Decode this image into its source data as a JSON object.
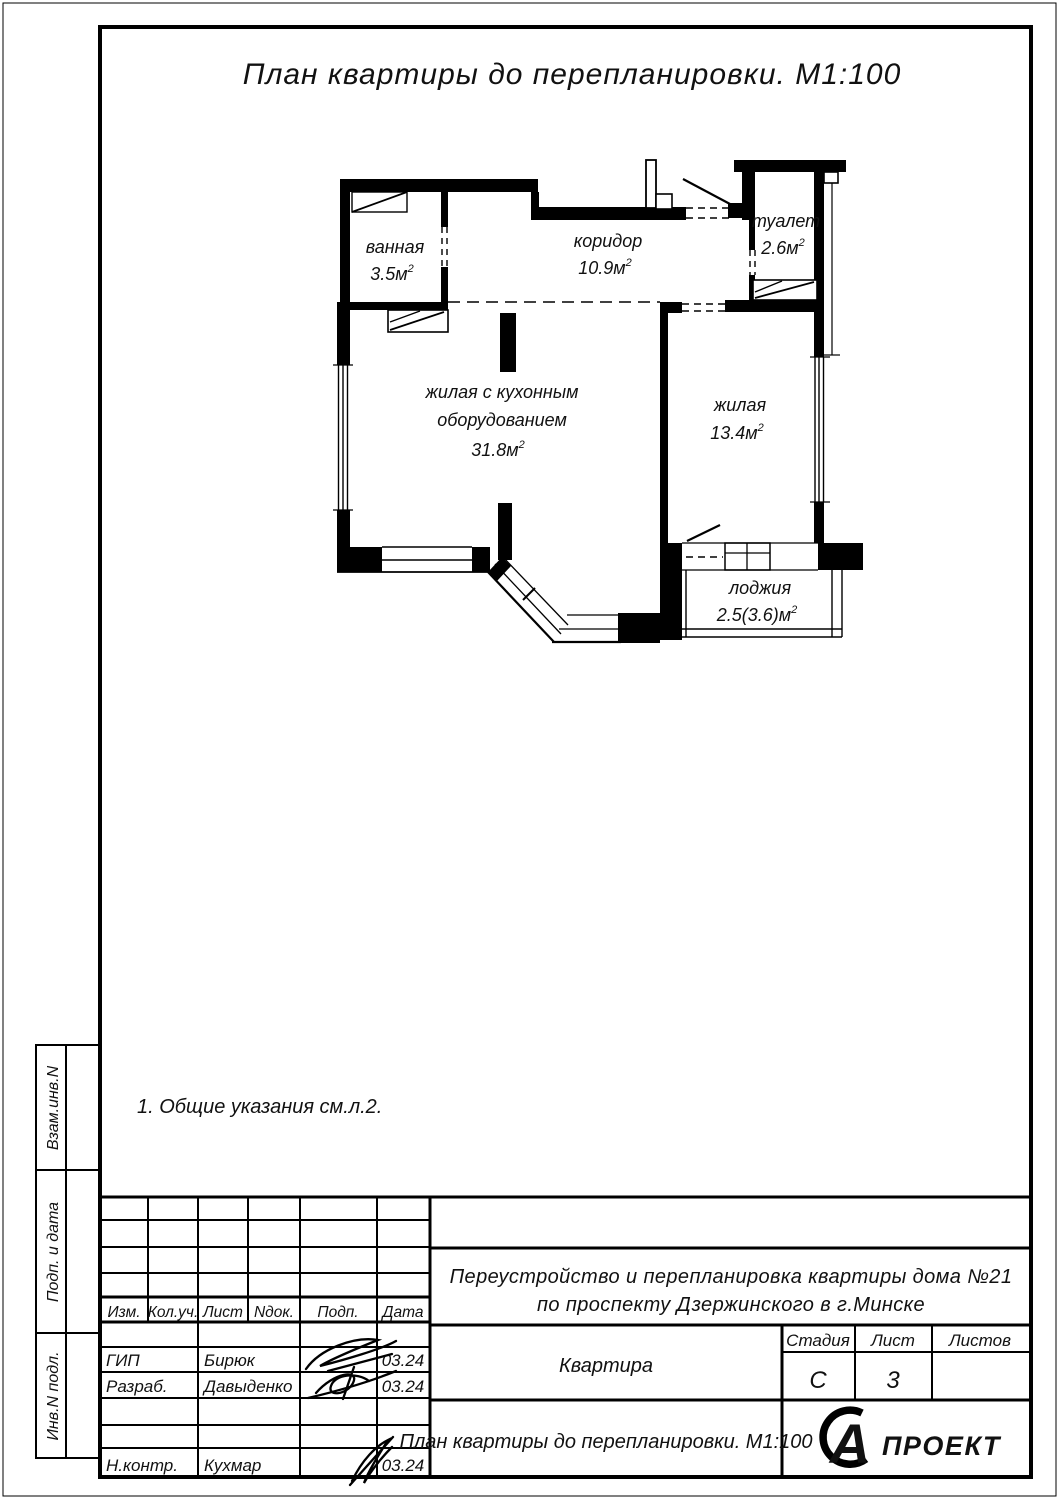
{
  "sheet_title": "План квартиры до перепланировки. М1:100",
  "note": "1.  Общие указания см.л.2.",
  "plan": {
    "rooms": {
      "bathroom": {
        "name": "ванная",
        "area": "3.5м",
        "sup": "2"
      },
      "corridor": {
        "name": "коридор",
        "area": "10.9м",
        "sup": "2"
      },
      "toilet": {
        "name": "туалет",
        "area": "2.6м",
        "sup": "2"
      },
      "living_kitchen": {
        "name_line1": "жилая с кухонным",
        "name_line2": "оборудованием",
        "area": "31.8м",
        "sup": "2"
      },
      "living": {
        "name": "жилая",
        "area": "13.4м",
        "sup": "2"
      },
      "loggia": {
        "name": "лоджия",
        "area": "2.5(3.6)м",
        "sup": "2"
      }
    }
  },
  "title_block": {
    "columns": [
      "Изм.",
      "Кол.уч.",
      "Лист",
      "Nдок.",
      "Подп.",
      "Дата"
    ],
    "rows": [
      {
        "role": "ГИП",
        "name": "Бирюк",
        "date": "03.24"
      },
      {
        "role": "Разраб.",
        "name": "Давыденко",
        "date": "03.24"
      },
      {
        "role": "Н.контр.",
        "name": "Кухмар",
        "date": "03.24"
      }
    ],
    "project_line1": "Переустройство и перепланировка квартиры дома №21",
    "project_line2": "по проспекту Дзержинского в г.Минске",
    "object_name": "Квартира",
    "stage_label": "Стадия",
    "sheet_label": "Лист",
    "sheets_label": "Листов",
    "stage_value": "С",
    "sheet_value": "3",
    "sheets_value": "",
    "drawing_title": "План квартиры до перепланировки. М1:100",
    "logo_letter": "А",
    "logo_text": "ПРОЕКТ"
  },
  "sidebar": {
    "labels": [
      "Взам.инв.N",
      "Подп. и дата",
      "Инв.N подл."
    ]
  },
  "colors": {
    "ink": "#111111",
    "paper": "#ffffff"
  }
}
